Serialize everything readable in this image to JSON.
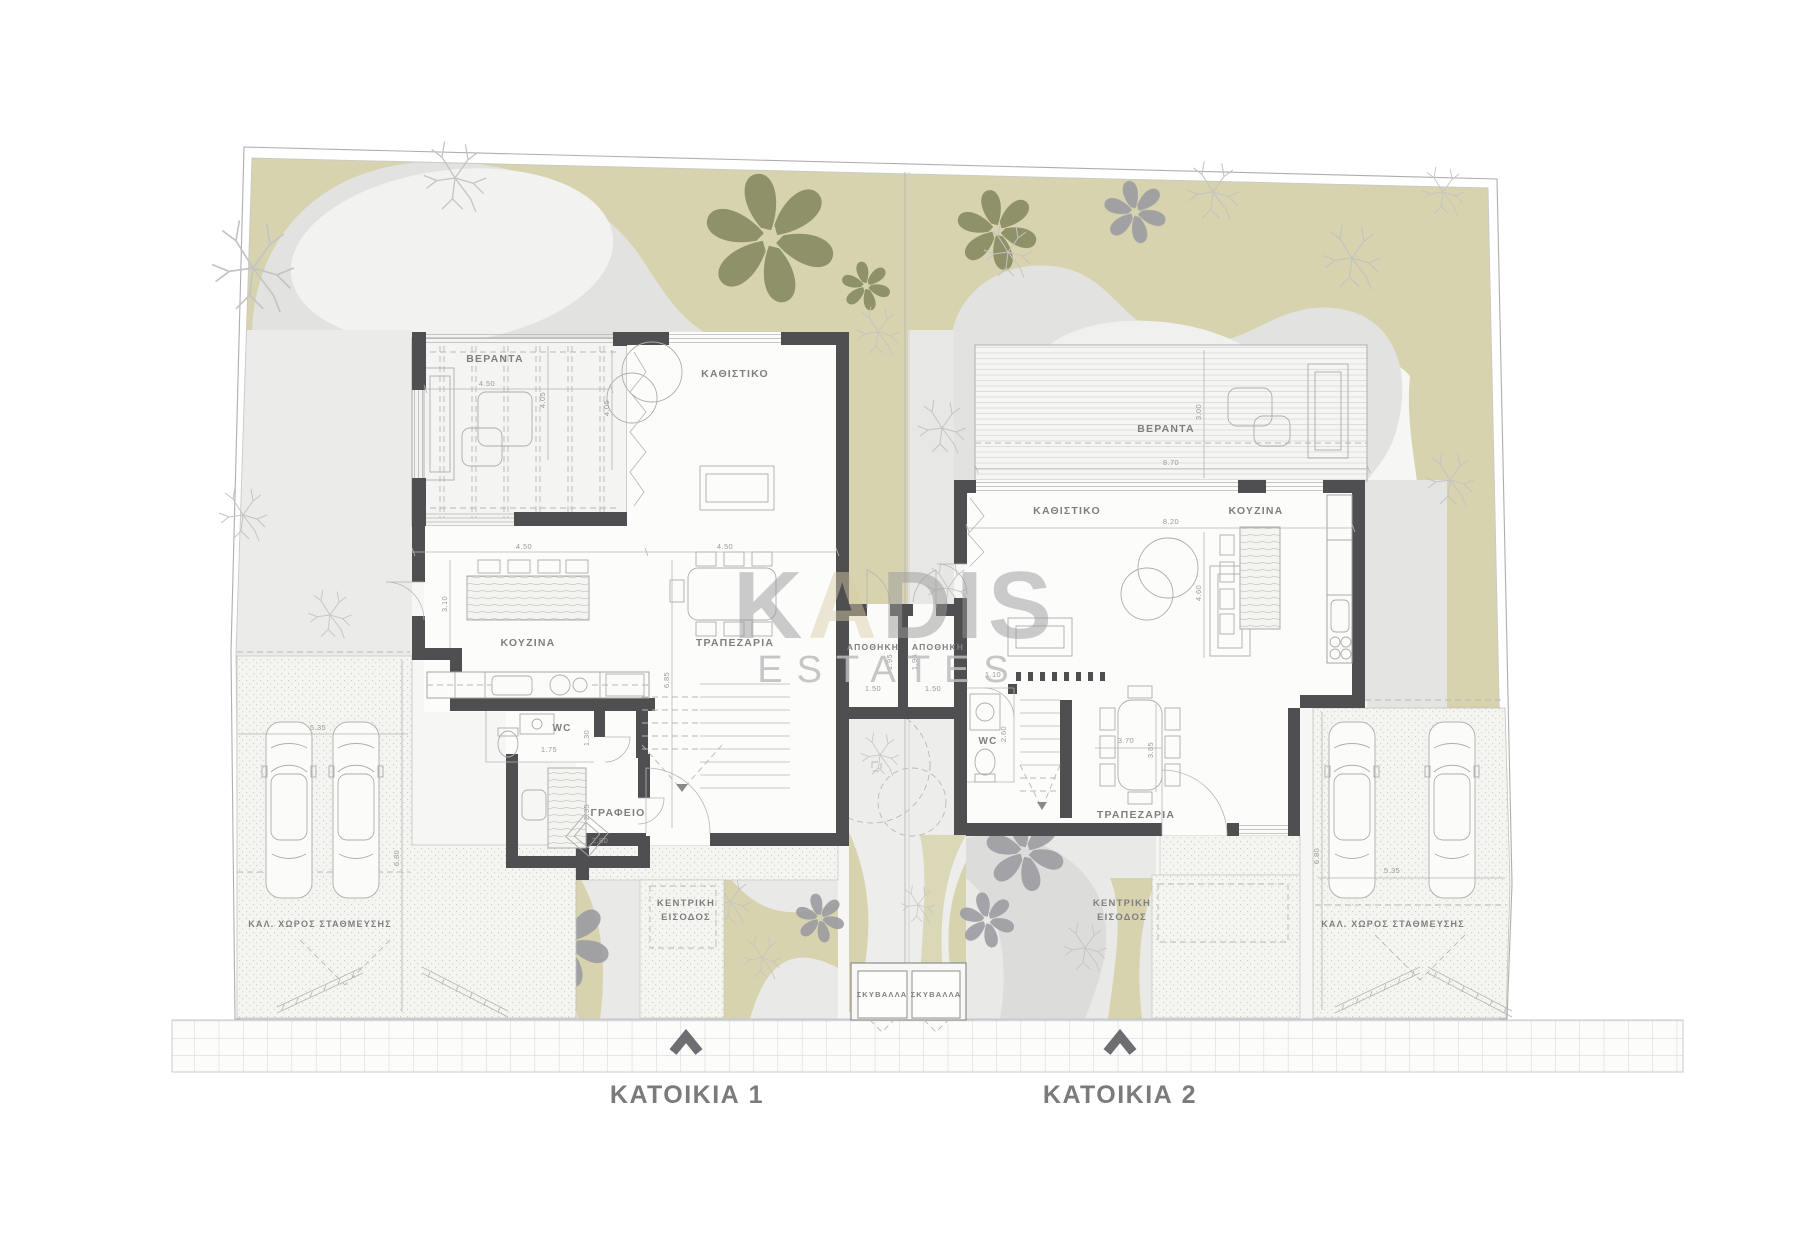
{
  "footer": {
    "house1_label": "ΚΑΤΟΙΚΙΑ 1",
    "house2_label": "ΚΑΤΟΙΚΙΑ 2"
  },
  "watermark": {
    "part1": "K",
    "part2": "A",
    "part3": "DIS",
    "sub": "ESTATES"
  },
  "rooms": [
    {
      "id": "veranda-1",
      "label": "ΒΕΡΑΝΤΑ",
      "x": 495,
      "y": 362,
      "size": 10.5
    },
    {
      "id": "living-1",
      "label": "ΚΑΘΙΣΤΙΚΟ",
      "x": 735,
      "y": 377,
      "size": 10.5
    },
    {
      "id": "kitchen-1",
      "label": "ΚΟΥΖΙΝΑ",
      "x": 528,
      "y": 646,
      "size": 10.5
    },
    {
      "id": "dining-1",
      "label": "ΤΡΑΠΕΖΑΡΙΑ",
      "x": 735,
      "y": 646,
      "size": 10.5
    },
    {
      "id": "wc-1",
      "label": "WC",
      "x": 562,
      "y": 731,
      "size": 10
    },
    {
      "id": "office-1",
      "label": "ΓΡΑΦΕΙΟ",
      "x": 618,
      "y": 816,
      "size": 10.5
    },
    {
      "id": "storage-1",
      "label": "ΑΠΟΘΗΚΗ",
      "x": 873,
      "y": 650,
      "size": 8.5
    },
    {
      "id": "storage-2",
      "label": "ΑΠΟΘΗΚΗ",
      "x": 938,
      "y": 650,
      "size": 8.5
    },
    {
      "id": "veranda-2",
      "label": "ΒΕΡΑΝΤΑ",
      "x": 1166,
      "y": 432,
      "size": 10.5
    },
    {
      "id": "living-2",
      "label": "ΚΑΘΙΣΤΙΚΟ",
      "x": 1067,
      "y": 514,
      "size": 10.5
    },
    {
      "id": "kitchen-2",
      "label": "ΚΟΥΖΙΝΑ",
      "x": 1256,
      "y": 514,
      "size": 10.5
    },
    {
      "id": "dining-2",
      "label": "ΤΡΑΠΕΖΑΡΙΑ",
      "x": 1136,
      "y": 818,
      "size": 10.5
    },
    {
      "id": "wc-2",
      "label": "WC",
      "x": 988,
      "y": 744,
      "size": 10
    },
    {
      "id": "parking-1",
      "label": "ΚΑΛ. ΧΩΡΟΣ ΣΤΑΘΜΕΥΣΗΣ",
      "x": 320,
      "y": 927,
      "size": 9
    },
    {
      "id": "parking-2",
      "label": "ΚΑΛ. ΧΩΡΟΣ ΣΤΑΘΜΕΥΣΗΣ",
      "x": 1393,
      "y": 927,
      "size": 9
    },
    {
      "id": "garbage-1",
      "label": "ΣΚΥΒΑΛΛΑ",
      "x": 882,
      "y": 997,
      "size": 7.5
    },
    {
      "id": "garbage-2",
      "label": "ΣΚΥΒΑΛΛΑ",
      "x": 936,
      "y": 997,
      "size": 7.5
    },
    {
      "id": "entrance-1a",
      "label": "ΚΕΝΤΡΙΚΗ",
      "x": 686,
      "y": 906,
      "size": 9.5
    },
    {
      "id": "entrance-1b",
      "label": "ΕΙΣΟΔΟΣ",
      "x": 686,
      "y": 920,
      "size": 9.5
    },
    {
      "id": "entrance-2a",
      "label": "ΚΕΝΤΡΙΚΗ",
      "x": 1122,
      "y": 906,
      "size": 9.5
    },
    {
      "id": "entrance-2b",
      "label": "ΕΙΣΟΔΟΣ",
      "x": 1122,
      "y": 920,
      "size": 9.5
    }
  ],
  "dimensions": [
    {
      "t": "4.50",
      "x": 487,
      "y": 386,
      "r": 0
    },
    {
      "t": "4.05",
      "x": 545,
      "y": 400,
      "r": -90
    },
    {
      "t": "4.05",
      "x": 609,
      "y": 408,
      "r": -90
    },
    {
      "t": "4.50",
      "x": 524,
      "y": 549,
      "r": 0
    },
    {
      "t": "4.50",
      "x": 725,
      "y": 549,
      "r": 0
    },
    {
      "t": "3.10",
      "x": 447,
      "y": 604,
      "r": -90
    },
    {
      "t": "6.85",
      "x": 669,
      "y": 680,
      "r": -90
    },
    {
      "t": "1.75",
      "x": 549,
      "y": 752,
      "r": 0
    },
    {
      "t": "1.30",
      "x": 589,
      "y": 738,
      "r": -90
    },
    {
      "t": "2.35",
      "x": 589,
      "y": 812,
      "r": -90
    },
    {
      "t": "2.80",
      "x": 600,
      "y": 843,
      "r": 0
    },
    {
      "t": "5.35",
      "x": 318,
      "y": 730,
      "r": 0
    },
    {
      "t": "6.80",
      "x": 399,
      "y": 858,
      "r": -90
    },
    {
      "t": "1.50",
      "x": 873,
      "y": 691,
      "r": 0
    },
    {
      "t": "1.50",
      "x": 933,
      "y": 691,
      "r": 0
    },
    {
      "t": "1.95",
      "x": 892,
      "y": 662,
      "r": -90
    },
    {
      "t": "1.95",
      "x": 917,
      "y": 662,
      "r": -90
    },
    {
      "t": "8.70",
      "x": 1171,
      "y": 465,
      "r": 0
    },
    {
      "t": "3.00",
      "x": 1201,
      "y": 412,
      "r": -90
    },
    {
      "t": "8.20",
      "x": 1171,
      "y": 524,
      "r": 0
    },
    {
      "t": "4.60",
      "x": 1201,
      "y": 593,
      "r": -90
    },
    {
      "t": "1.10",
      "x": 993,
      "y": 677,
      "r": 0
    },
    {
      "t": "2.60",
      "x": 1006,
      "y": 734,
      "r": -90
    },
    {
      "t": "3.70",
      "x": 1126,
      "y": 743,
      "r": 0
    },
    {
      "t": "3.85",
      "x": 1153,
      "y": 750,
      "r": -90
    },
    {
      "t": "5.35",
      "x": 1392,
      "y": 873,
      "r": 0
    },
    {
      "t": "6.80",
      "x": 1319,
      "y": 856,
      "r": -90
    }
  ],
  "colors": {
    "garden_beige": "#d6d3ae",
    "tree_olive": "#8a8c63",
    "tree_gray": "#9b9ba2",
    "path_gray": "#e2e2e0",
    "wall_dark": "#4f4f51",
    "label_gray": "#7f7f7f",
    "watermark_accent": "#d8cba4"
  }
}
